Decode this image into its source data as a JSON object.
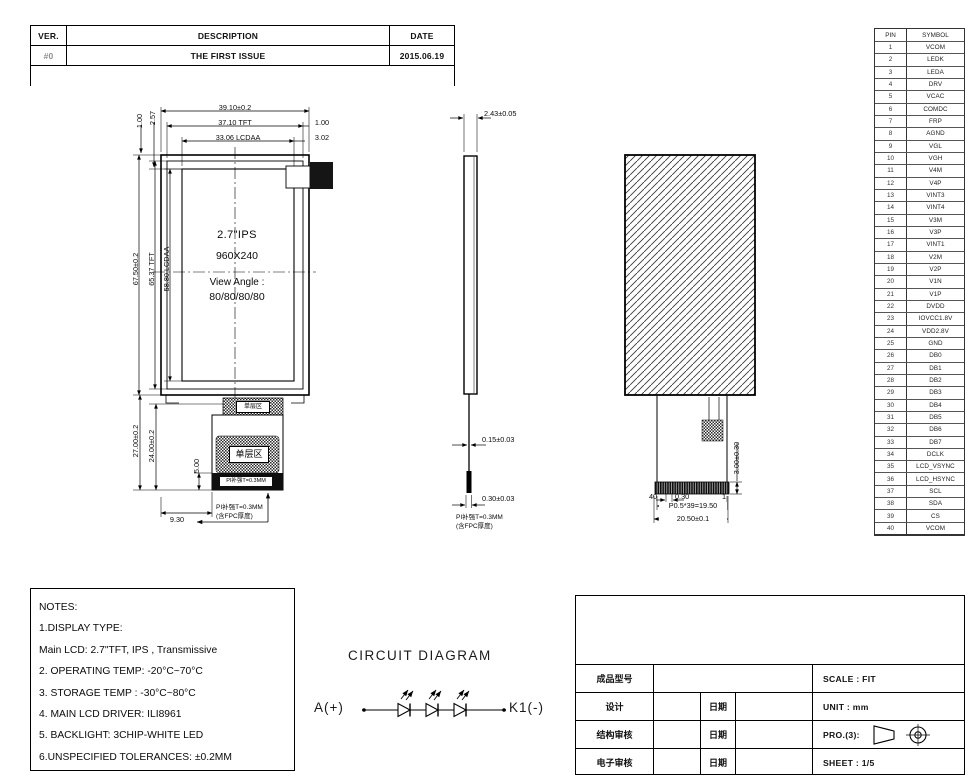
{
  "revision_table": {
    "headers": {
      "ver": "VER.",
      "description": "DESCRIPTION",
      "date": "DATE"
    },
    "row": {
      "ver": "#0",
      "description": "THE FIRST ISSUE",
      "date": "2015.06.19"
    }
  },
  "pin_table": {
    "headers": {
      "pin": "PIN",
      "symbol": "SYMBOL"
    },
    "pins": [
      {
        "pin": "1",
        "symbol": "VCOM"
      },
      {
        "pin": "2",
        "symbol": "LEDK"
      },
      {
        "pin": "3",
        "symbol": "LEDA"
      },
      {
        "pin": "4",
        "symbol": "DRV"
      },
      {
        "pin": "5",
        "symbol": "VCAC"
      },
      {
        "pin": "6",
        "symbol": "COMDC"
      },
      {
        "pin": "7",
        "symbol": "FRP"
      },
      {
        "pin": "8",
        "symbol": "AGND"
      },
      {
        "pin": "9",
        "symbol": "VGL"
      },
      {
        "pin": "10",
        "symbol": "VGH"
      },
      {
        "pin": "11",
        "symbol": "V4M"
      },
      {
        "pin": "12",
        "symbol": "V4P"
      },
      {
        "pin": "13",
        "symbol": "VINT3"
      },
      {
        "pin": "14",
        "symbol": "VINT4"
      },
      {
        "pin": "15",
        "symbol": "V3M"
      },
      {
        "pin": "16",
        "symbol": "V3P"
      },
      {
        "pin": "17",
        "symbol": "VINT1"
      },
      {
        "pin": "18",
        "symbol": "V2M"
      },
      {
        "pin": "19",
        "symbol": "V2P"
      },
      {
        "pin": "20",
        "symbol": "V1N"
      },
      {
        "pin": "21",
        "symbol": "V1P"
      },
      {
        "pin": "22",
        "symbol": "DVDD"
      },
      {
        "pin": "23",
        "symbol": "IOVCC1.8V"
      },
      {
        "pin": "24",
        "symbol": "VDD2.8V"
      },
      {
        "pin": "25",
        "symbol": "GND"
      },
      {
        "pin": "26",
        "symbol": "DB0"
      },
      {
        "pin": "27",
        "symbol": "DB1"
      },
      {
        "pin": "28",
        "symbol": "DB2"
      },
      {
        "pin": "29",
        "symbol": "DB3"
      },
      {
        "pin": "30",
        "symbol": "DB4"
      },
      {
        "pin": "31",
        "symbol": "DB5"
      },
      {
        "pin": "32",
        "symbol": "DB6"
      },
      {
        "pin": "33",
        "symbol": "DB7"
      },
      {
        "pin": "34",
        "symbol": "DCLK"
      },
      {
        "pin": "35",
        "symbol": "LCD_VSYNC"
      },
      {
        "pin": "36",
        "symbol": "LCD_HSYNC"
      },
      {
        "pin": "37",
        "symbol": "SCL"
      },
      {
        "pin": "38",
        "symbol": "SDA"
      },
      {
        "pin": "39",
        "symbol": "CS"
      },
      {
        "pin": "40",
        "symbol": "VCOM"
      }
    ]
  },
  "front": {
    "size_label": "2.7\"IPS",
    "resolution": "960X240",
    "view_angle_title": "View Angle :",
    "view_angle": "80/80/80/80",
    "dim_width": "39.10±0.2",
    "dim_width_tft": "37.10 TFT",
    "dim_width_lcdaa": "33.06 LCDAA",
    "dim_right1": "1.00",
    "dim_right2": "3.02",
    "dim_top1": "1.00",
    "dim_top2": "2.57",
    "dim_height": "67.50±0.2",
    "dim_height_tft": "65.37 TFT",
    "dim_height_lcdaa": "58.80 LCDAA",
    "dim_fpc1": "27.00±0.2",
    "dim_fpc2": "24.00±0.2",
    "dim_pi": "5.00",
    "dim_fpc_offset": "9.30",
    "single_layer_top": "单层区",
    "single_layer_main": "单层区",
    "pi_strip": "PI补强T=0.3MM",
    "callout1": "PI补强T=0.3MM",
    "callout2": "(含FPC厚度)"
  },
  "side": {
    "dim_thickness": "2.43±0.05",
    "dim_fpc": "0.15±0.03",
    "dim_pi": "0.30±0.03",
    "callout1": "PI补强T=0.3MM",
    "callout2": "(含FPC厚度)"
  },
  "rear": {
    "dim_connector": "3.00±0.30",
    "pin_first": "40",
    "pin_last": "1",
    "dim_pitch": "0.30",
    "dim_pitch_total": "P0.5*39=19.50",
    "dim_width": "20.50±0.1"
  },
  "circuit": {
    "title": "CIRCUIT DIAGRAM",
    "anode": "A(+)",
    "cathode": "K1(-)"
  },
  "notes": {
    "lines": [
      "NOTES:",
      "1.DISPLAY TYPE:",
      " Main LCD: 2.7\"TFT, IPS , Transmissive",
      "2. OPERATING TEMP: -20°C~70°C",
      "3. STORAGE TEMP : -30°C~80°C",
      "4. MAIN LCD DRIVER: ILI8961",
      "5. BACKLIGHT: 3CHIP-WHITE LED",
      "6.UNSPECIFIED TOLERANCES: ±0.2MM"
    ]
  },
  "title_block": {
    "product_model_label": "成品型号",
    "design_label": "设计",
    "structure_review_label": "结构审核",
    "electronic_review_label": "电子审核",
    "date_label": "日期",
    "scale": "SCALE : FIT",
    "unit": "UNIT : mm",
    "projection_label": "PRO.(3):",
    "sheet": "SHEET : 1/5"
  }
}
